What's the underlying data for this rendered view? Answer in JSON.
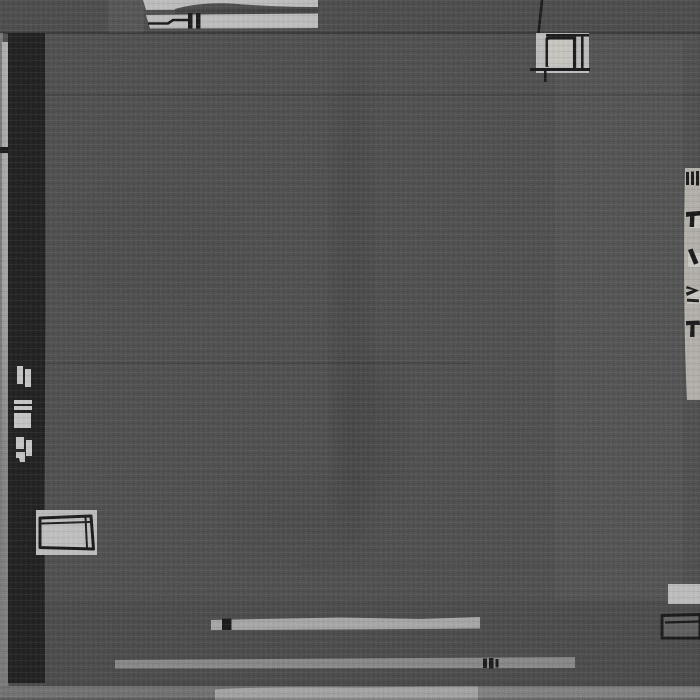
{
  "image": {
    "kind": "photograph",
    "subject": "Modern abstract charcoal gray wool rug with black and light-gray geometric line motifs",
    "motifs": {
      "left_black_bar": "long vertical black bar with small light tick marks",
      "left_edge_strip": "narrow light selvedge strip on far left with black tick",
      "top_left_block": "light gray double strip with black line drawing",
      "top_right_block": "small light square with black outlined box and drop line from top edge",
      "right_edge_strip": "light strip at right edge carrying small black glyph marks",
      "left_outlined_box": "light rectangle with heavy black outline over the black bar",
      "bottom_stripes": "light and mid-gray horizontal stripes with small black tick marks",
      "bottom_right_box": "black outlined rectangle beside a light block",
      "bottom_band": "light-gray banded lower edge of the rug"
    }
  },
  "palette": {
    "field": "#484848",
    "field_top": "#454545",
    "black_bar": "#1b1b1b",
    "ink": "#141414",
    "light_block": "#b9b9b9",
    "light_inner": "#c8c6c0",
    "right_strip": "#aeaaa3",
    "edge_strip_top": "#a9a9a9",
    "edge_strip_bottom": "#6f6f6f",
    "left_edge": "#6e6e6e",
    "stripe_light": "#a0a0a0",
    "stripe_mid": "#7e7e7e",
    "band_left": "#696969",
    "band_mid": "#9c9c9c",
    "band_right": "#787878",
    "box_fill": "#575757",
    "bar_mark": "#c2c2c2",
    "smudge": "#2e2e2e"
  }
}
